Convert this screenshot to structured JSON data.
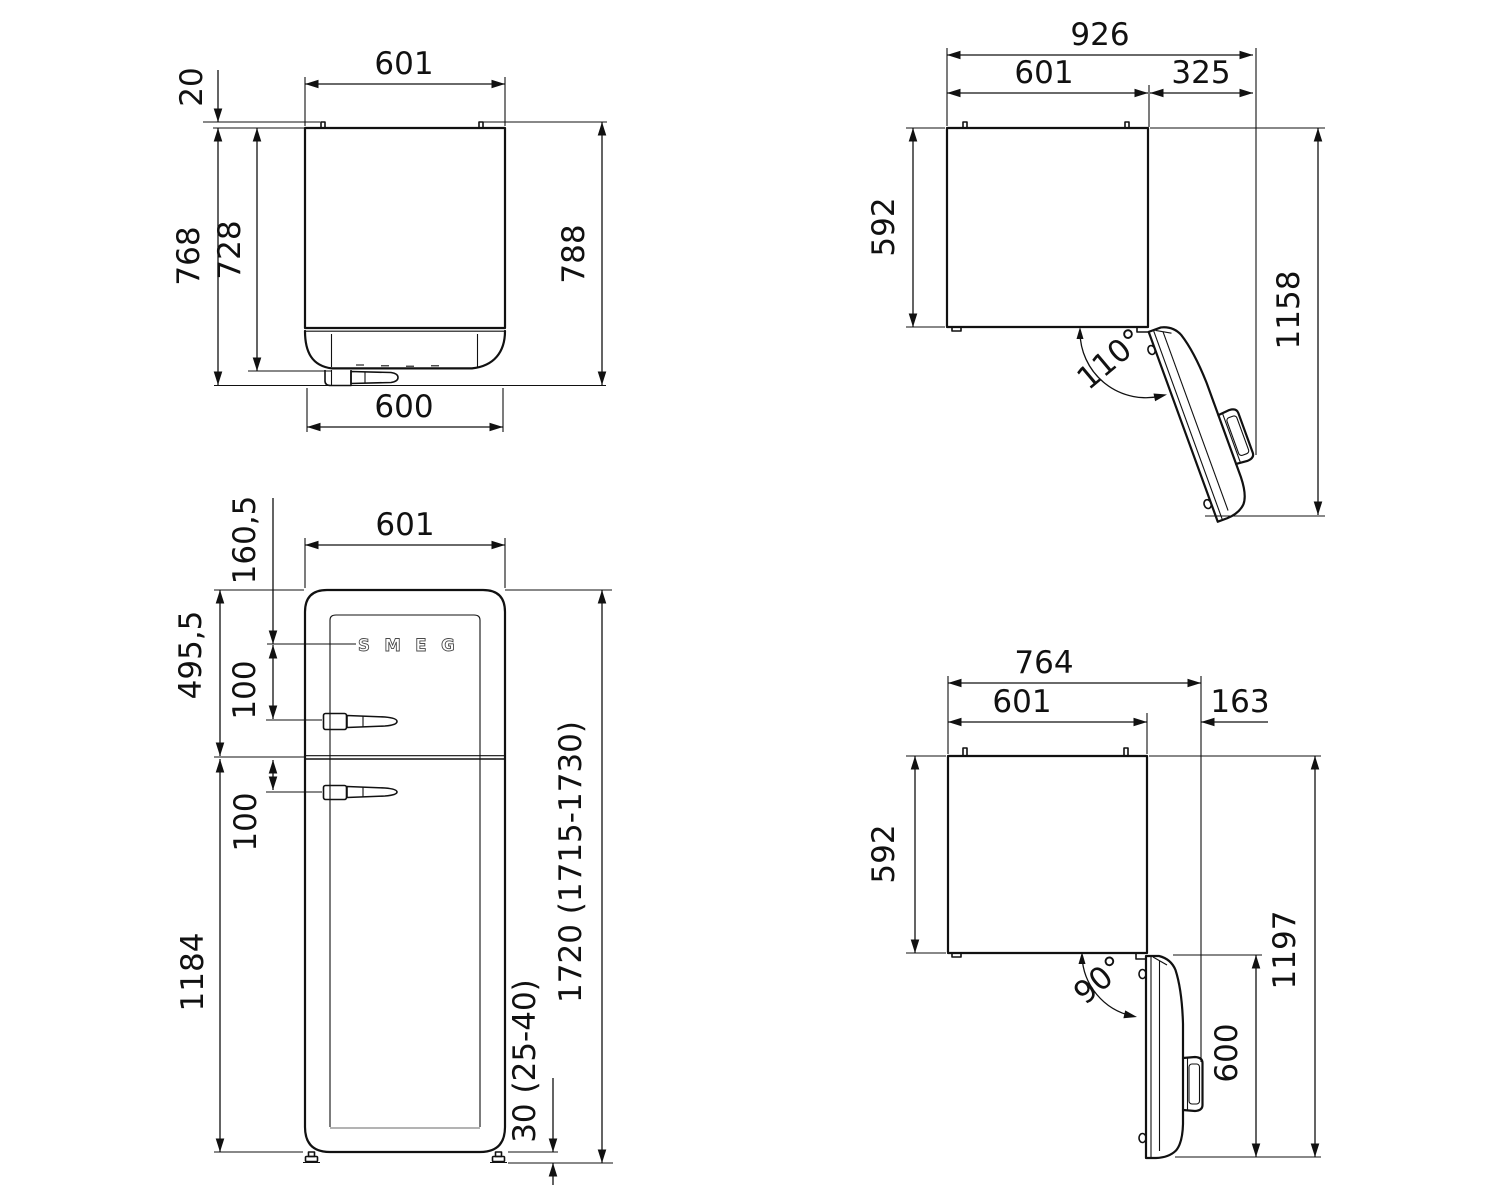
{
  "drawing": {
    "product": "refrigerator-dimension-diagram",
    "units": "mm",
    "colors": {
      "line": "#111111",
      "background": "#ffffff",
      "logo_outline": "#4a4a4a",
      "plinth_gray": "#9a9a9a"
    },
    "views": {
      "top_closed": {
        "dims": {
          "width_top": "601",
          "rear_spacer": "20",
          "depth_with_door": "768",
          "cabinet_depth": "728",
          "total_depth": "788",
          "door_width": "600"
        }
      },
      "top_open_110": {
        "dims": {
          "total_width": "926",
          "cabinet_width": "601",
          "door_swing_extra": "325",
          "cabinet_depth": "592",
          "total_depth_open": "1158",
          "door_angle": "110°"
        }
      },
      "front": {
        "logo": "SMEG",
        "dims": {
          "width": "601",
          "top_to_logo": "160,5",
          "upper_section": "495,5",
          "logo_to_handle": "100",
          "split_to_handle": "100",
          "lower_section": "1184",
          "total_height": "1720 (1715-1730)",
          "feet_height": "30 (25-40)"
        }
      },
      "top_open_90": {
        "dims": {
          "total_width": "764",
          "cabinet_width": "601",
          "door_swing_extra": "163",
          "cabinet_depth": "592",
          "total_depth_open": "1197",
          "door_width": "600",
          "door_angle": "90°"
        }
      }
    }
  }
}
